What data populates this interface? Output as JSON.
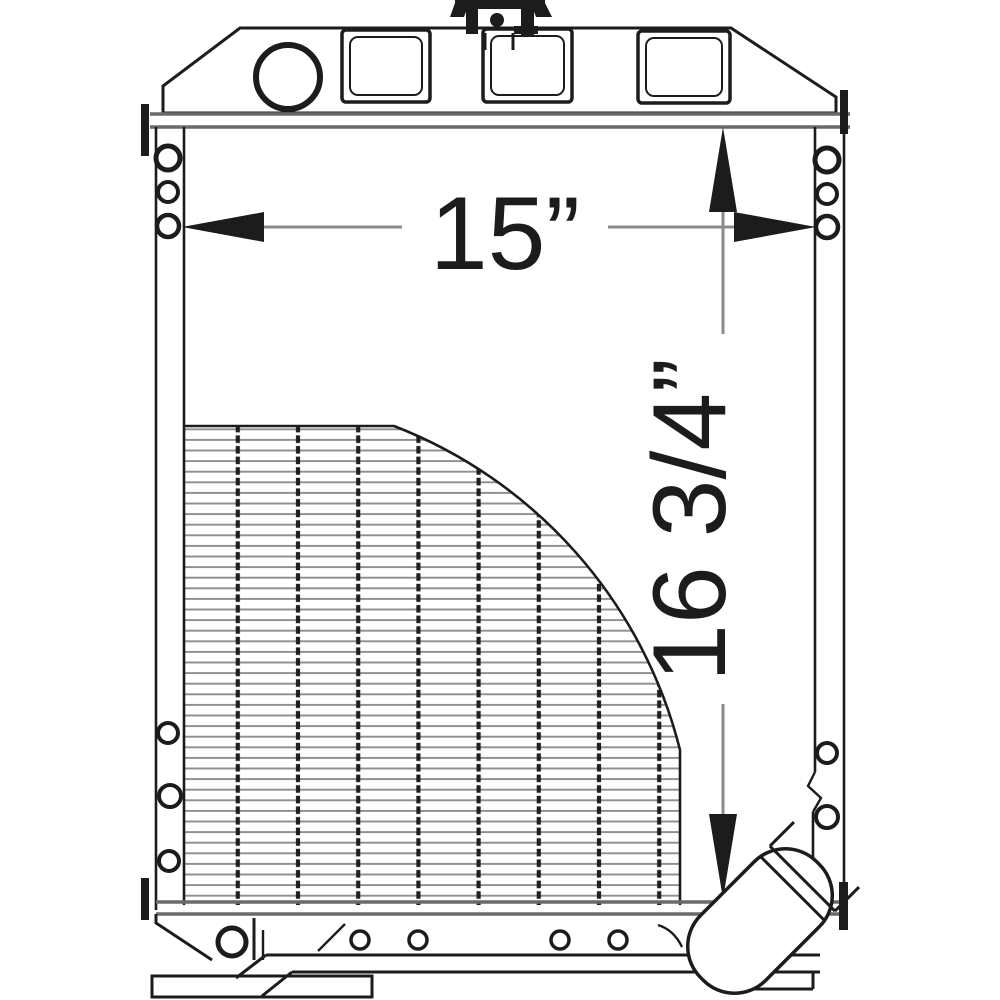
{
  "figure": {
    "dimensions": {
      "width_label": "15”",
      "height_label": "16 3/4”"
    },
    "colors": {
      "ink": "#1c1c1c",
      "soft": "#8a8a8a",
      "band": "#6a6a6a",
      "background": "#ffffff"
    }
  }
}
